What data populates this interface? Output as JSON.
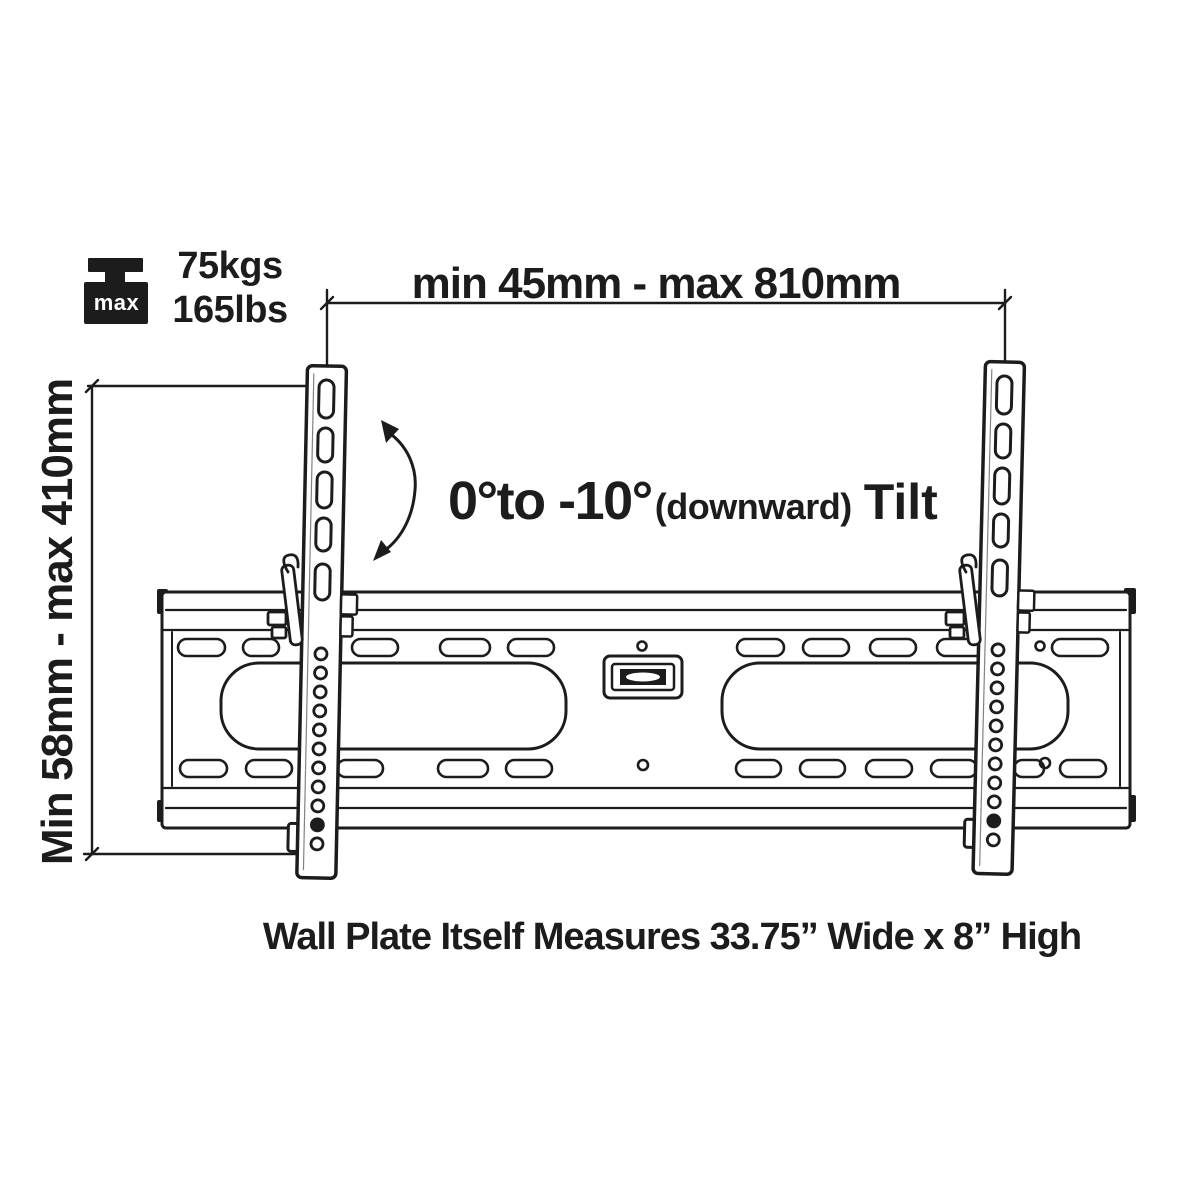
{
  "diagram": {
    "weight_capacity": {
      "icon": "weight-max-icon",
      "icon_label": "max",
      "kg": "75kgs",
      "lbs": "165lbs"
    },
    "width_dimension_label": "min 45mm - max 810mm",
    "height_dimension_label": "Min 58mm - max 410mm",
    "tilt": {
      "range": "0°to -10°",
      "note": "(downward)",
      "word": "Tilt"
    },
    "caption": "Wall Plate Itself Measures 33.75” Wide x 8” High"
  },
  "colors": {
    "ink": "#1c1c1c",
    "background": "#ffffff"
  }
}
